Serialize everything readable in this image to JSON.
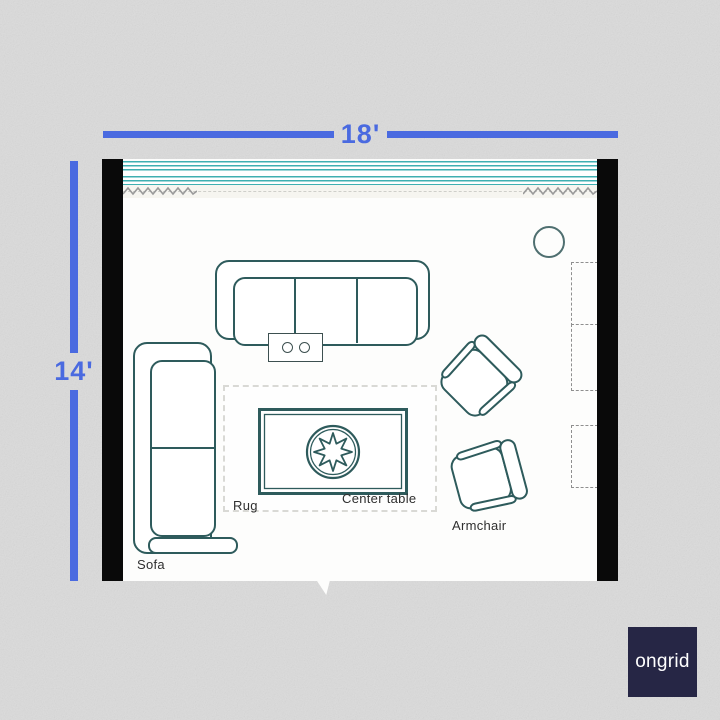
{
  "dimensions": {
    "width_label": "18'",
    "height_label": "14'"
  },
  "furniture_labels": {
    "sofa": "Sofa",
    "rug": "Rug",
    "center_table": "Center table",
    "armchair": "Armchair"
  },
  "logo": {
    "text": "ongrid"
  },
  "colors": {
    "dimension_blue": "#4a6ae0",
    "furniture_outline": "#2e5b5c",
    "window_teal": "#3fafb1",
    "wall_black": "#090909",
    "background_gray": "#dbdbdb",
    "logo_background": "#262645"
  }
}
